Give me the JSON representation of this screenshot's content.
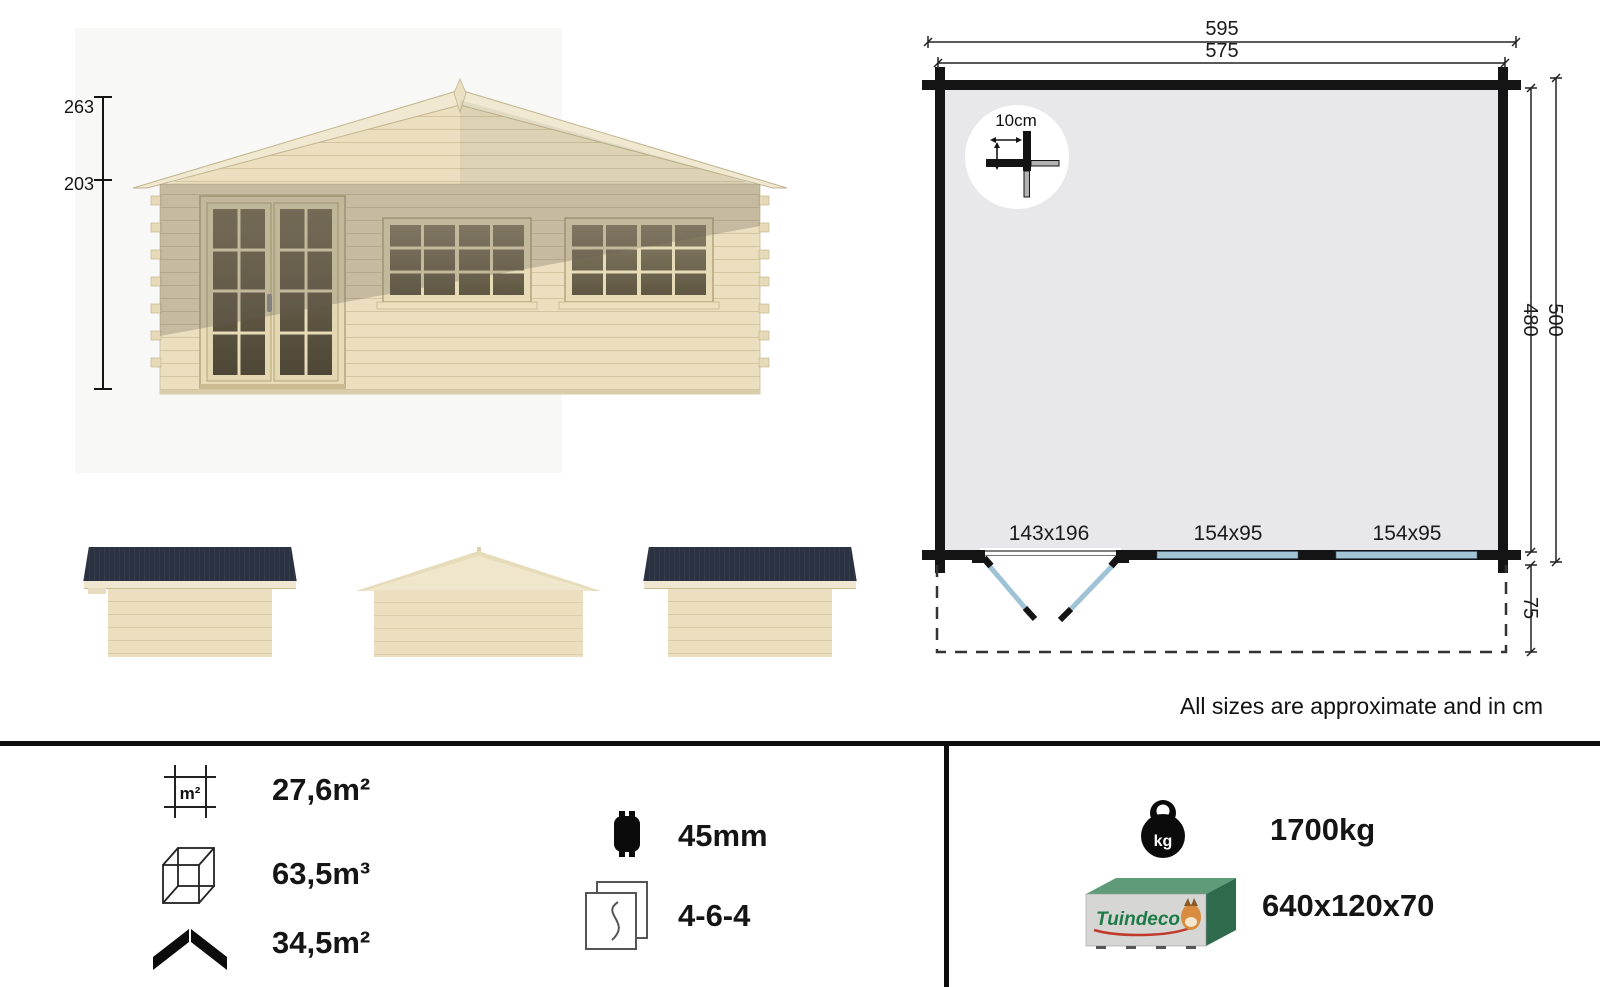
{
  "front_view": {
    "ridge_height": "263",
    "eave_height": "203"
  },
  "floor_plan": {
    "width_outer": "595",
    "width_inner": "575",
    "depth_inner": "480",
    "depth_outer": "500",
    "terrace_depth": "75",
    "corner_log_detail": "10cm",
    "door_size": "143x196",
    "window_left_size": "154x95",
    "window_right_size": "154x95"
  },
  "note": "All sizes are approximate and in cm",
  "specs": {
    "floor_area": "27,6m²",
    "volume": "63,5m³",
    "roof_area": "34,5m²",
    "wall_thickness": "45mm",
    "glazing": "4-6-4",
    "weight": "1700kg",
    "package_size": "640x120x70"
  },
  "package": {
    "brand": "Tuindeco"
  },
  "colors": {
    "accent_window_blue": "#a4c5d6",
    "plan_interior": "#e8e8ea",
    "roof_dark": "#2b3240",
    "wood_light": "#ebdfbf",
    "package_green": "#2e6b4d"
  }
}
